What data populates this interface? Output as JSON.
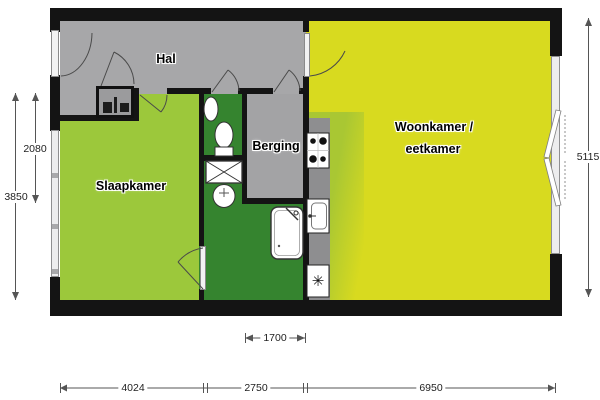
{
  "floorplan": {
    "rooms": {
      "hal": {
        "label": "Hal"
      },
      "slaapkamer": {
        "label": "Slaapkamer"
      },
      "berging": {
        "label": "Berging"
      },
      "woonkamer": {
        "label_line1": "Woonkamer /",
        "label_line2": "eetkamer"
      }
    },
    "dimensions": {
      "left_inner": "2080",
      "left_outer": "3850",
      "right_side": "5115",
      "kitchen_width": "1700",
      "bottom_left": "4024",
      "bottom_middle": "2750",
      "bottom_right": "6950"
    },
    "symbols": {
      "freezer": "✳"
    },
    "colors": {
      "living_room": "#d8da1f",
      "bedroom": "#9cc83b",
      "bathroom": "#35842f",
      "kitchen_zone": "#a9c733",
      "hall_storage": "#a7a7a9",
      "counter": "#8e8e90",
      "wall": "#141414"
    }
  }
}
